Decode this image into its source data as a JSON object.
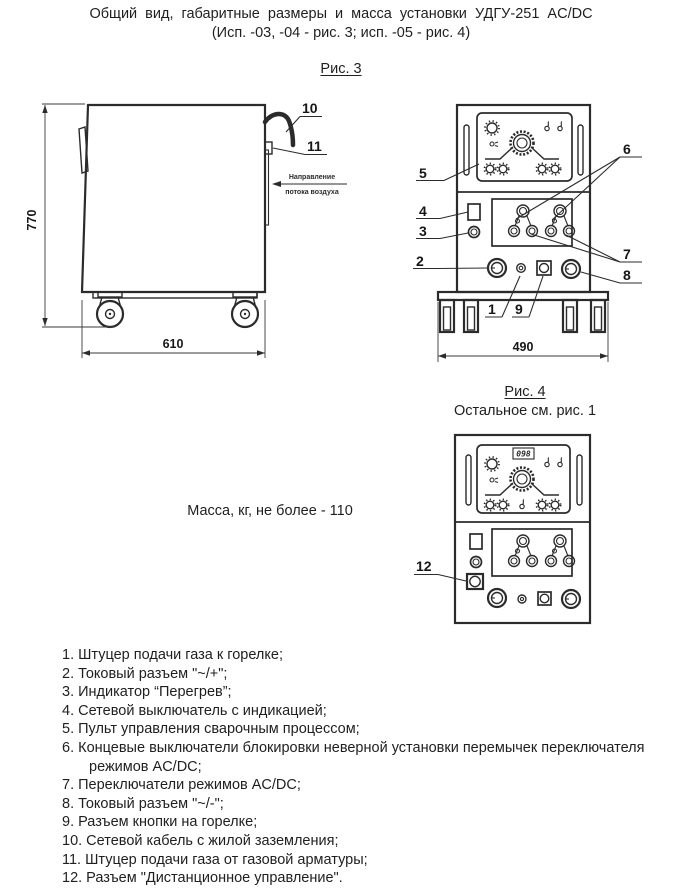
{
  "title": {
    "line1": "Общий вид, габаритные размеры и масса установки УДГУ-251 AC/DC",
    "line2": "(Исп. -03, -04 - рис. 3; исп. -05 - рис. 4)"
  },
  "fig3": {
    "caption": "Рис. 3",
    "side": {
      "dim_height": "770",
      "dim_width": "610",
      "callout_cable": "10",
      "callout_gas_fitting": "11",
      "airflow_line1": "Направление",
      "airflow_line2": "потока воздуха"
    },
    "front": {
      "dim_width": "490",
      "c1": "1",
      "c2": "2",
      "c3": "3",
      "c4": "4",
      "c5": "5",
      "c6": "6",
      "c7": "7",
      "c8": "8",
      "c9": "9"
    }
  },
  "fig4": {
    "caption": "Рис. 4",
    "note": "Остальное см. рис. 1",
    "display_value": "098",
    "c12": "12"
  },
  "mass_note": "Масса, кг, не более - 110",
  "legend": {
    "items": [
      "1. Штуцер подачи газа к горелке;",
      "2. Токовый разъем \"~/+\";",
      "3. Индикатор “Перегрев”;",
      "4. Сетевой выключатель с индикацией;",
      "5. Пульт управления сварочным процессом;",
      "6. Концевые выключатели блокировки неверной установки перемычек переключателя режимов AC/DC;",
      "7. Переключатели режимов AC/DC;",
      "8. Токовый разъем \"~/-\";",
      "9. Разъем кнопки на горелке;",
      "10. Сетевой кабель с жилой заземления;",
      "11. Штуцер подачи газа от газовой арматуры;",
      "12. Разъем \"Дистанционное управление\"."
    ]
  }
}
